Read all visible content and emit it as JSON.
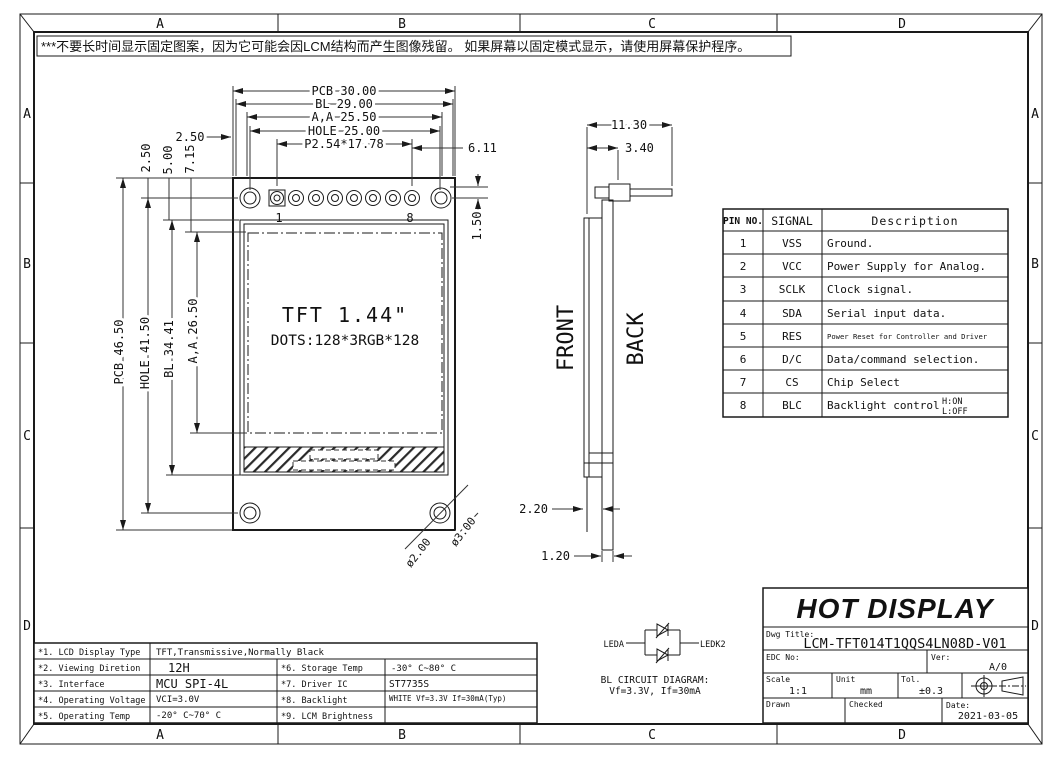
{
  "warning": {
    "text": "***不要长时间显示固定图案，因为它可能会因LCM结构而产生图像残留。 如果屏幕以固定模式显示，请使用屏幕保护程序。"
  },
  "grid": {
    "cols": [
      "A",
      "B",
      "C",
      "D"
    ],
    "rows": [
      "A",
      "B",
      "C",
      "D"
    ]
  },
  "colors": {
    "line": "#1a1a1a",
    "background": "#ffffff"
  },
  "front_view": {
    "dims_top": [
      "PCB 30.00",
      "BL 29.00",
      "A,A 25.50",
      "HOLE 25.00",
      "P2.54*17.78"
    ],
    "dim_edge": "2.50",
    "dim_pin8_to_edge": "6.11",
    "dim_pad_row": "1.50",
    "dims_left": [
      "PCB 46.50",
      "HOLE 41.50",
      "BL 34.41",
      "A,A 26.50"
    ],
    "dims_left_top": [
      "2.50",
      "5.00",
      "7.15"
    ],
    "pin_first": "1",
    "pin_last": "8",
    "screen_title": "TFT 1.44\"",
    "screen_dots": "DOTS:128*3RGB*128",
    "dia_inner": "ø2.00",
    "dia_outer": "ø3.00"
  },
  "side_view": {
    "dim_total": "11.30",
    "dim_header": "3.40",
    "label_front": "FRONT",
    "label_back": "BACK",
    "dim_module": "2.20",
    "dim_pcb": "1.20"
  },
  "pin_table": {
    "headers": [
      "PIN NO.",
      "SIGNAL",
      "Description"
    ],
    "rows": [
      {
        "no": "1",
        "signal": "VSS",
        "desc": "Ground."
      },
      {
        "no": "2",
        "signal": "VCC",
        "desc": "Power Supply for Analog."
      },
      {
        "no": "3",
        "signal": "SCLK",
        "desc": "Clock signal."
      },
      {
        "no": "4",
        "signal": "SDA",
        "desc": "Serial input data."
      },
      {
        "no": "5",
        "signal": "RES",
        "desc": "Power Reset for Controller and Driver"
      },
      {
        "no": "6",
        "signal": "D/C",
        "desc": "Data/command selection."
      },
      {
        "no": "7",
        "signal": "CS",
        "desc": "Chip Select"
      },
      {
        "no": "8",
        "signal": "BLC",
        "desc": "Backlight control",
        "state_high": "H:ON",
        "state_low": "L:OFF"
      }
    ]
  },
  "bl_circuit": {
    "label_left": "LEDA",
    "label_right": "LEDK2",
    "title": "BL CIRCUIT DIAGRAM:",
    "subtitle": "Vf=3.3V, If=30mA"
  },
  "spec_table": {
    "rows": [
      {
        "label": "*1. LCD Display Type",
        "value": "TFT,Transmissive,Normally Black",
        "label2": "",
        "value2": ""
      },
      {
        "label": "*2. Viewing Diretion",
        "value": "12H",
        "label2": "*6. Storage Temp",
        "value2": "-30° C~80° C"
      },
      {
        "label": "*3. Interface",
        "value": "MCU SPI-4L",
        "label2": "*7. Driver IC",
        "value2": "ST7735S"
      },
      {
        "label": "*4. Operating Voltage",
        "value": "VCI=3.0V",
        "label2": "*8. Backlight",
        "value2": "WHITE Vf=3.3V If=30mA(Typ)"
      },
      {
        "label": "*5. Operating Temp",
        "value": "-20° C~70° C",
        "label2": "*9. LCM Brightness",
        "value2": ""
      }
    ]
  },
  "title_block": {
    "company": "HOT DISPLAY",
    "dwg_title_label": "Dwg Title:",
    "dwg_title": "LCM-TFT014T1QQS4LN08D-V01",
    "edc_label": "EDC No:",
    "ver_label": "Ver:",
    "version": "A/0",
    "scale_label": "Scale",
    "scale": "1:1",
    "unit_label": "Unit",
    "unit": "mm",
    "tol_label": "Tol.",
    "tolerance": "±0.3",
    "drawn_label": "Drawn",
    "checked_label": "Checked",
    "date_label": "Date:",
    "date": "2021-03-05"
  }
}
